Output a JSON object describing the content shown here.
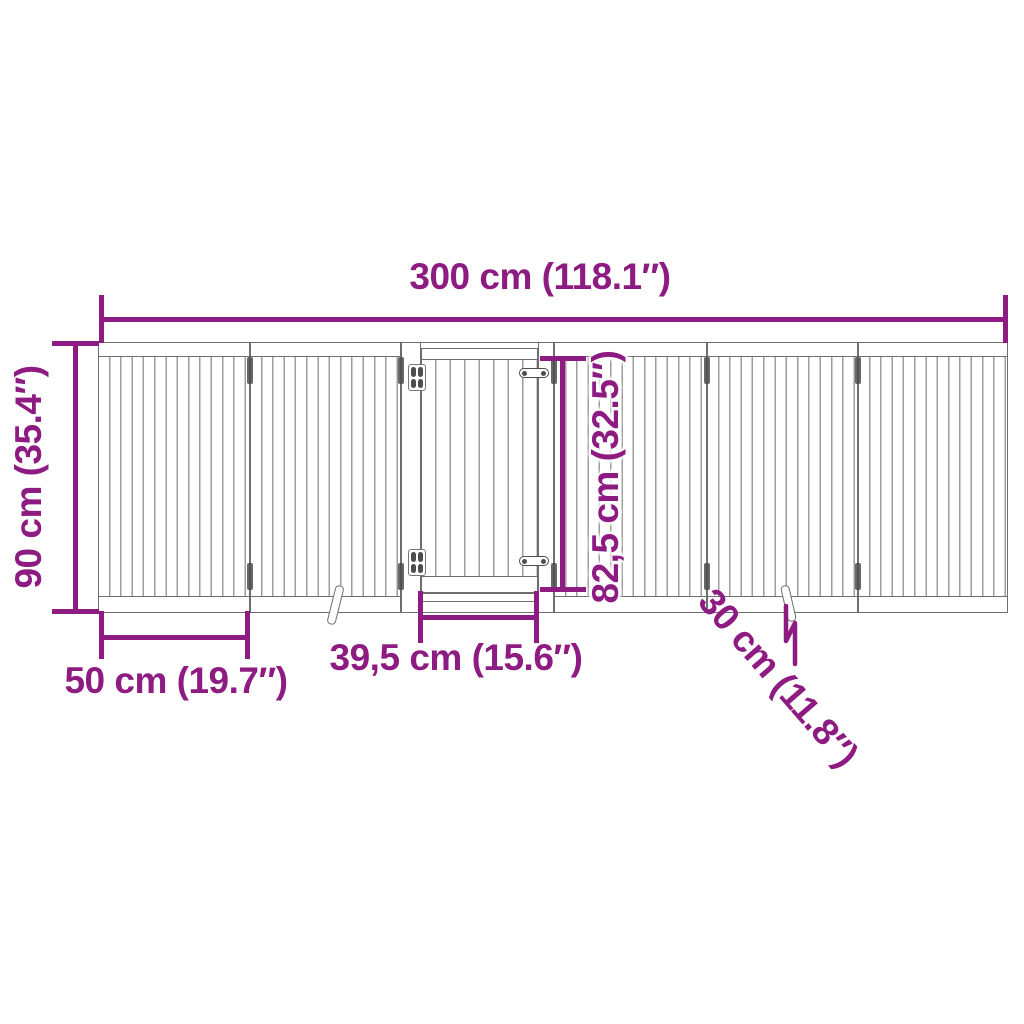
{
  "diagram": {
    "type": "product-dimension-diagram",
    "subject": "foldable pet gate with door, 6 panels, front view",
    "structure": {
      "panel_count": 6,
      "door_section_position": 3,
      "feet_count": 2
    },
    "dimensions": {
      "total_width": "300 cm (118.1″)",
      "height": "90 cm (35.4″)",
      "panel_width": "50 cm (19.7″)",
      "door_width": "39,5 cm (15.6″)",
      "door_height": "82,5 cm (32.5″)",
      "foot_length": "30 cm (11.8″)"
    },
    "colors": {
      "accent": "#8E1B82",
      "frame": "#6e6e6e",
      "slat": "#9c9c9c",
      "hardware": "#4d4d4d",
      "background": "#ffffff"
    }
  }
}
